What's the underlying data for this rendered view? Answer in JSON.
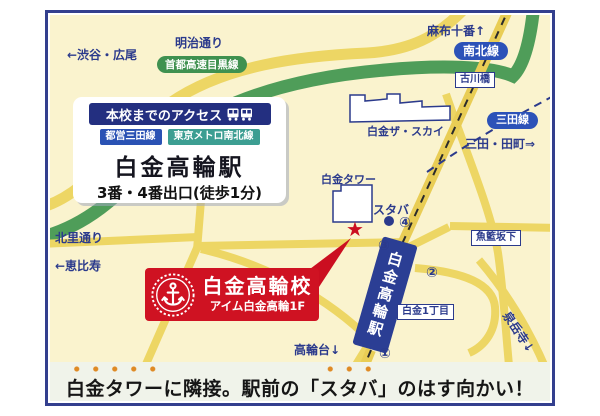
{
  "access_box": {
    "header": "本校までのアクセス",
    "line_badges": [
      {
        "label": "都営三田線",
        "color": "#2A52B4"
      },
      {
        "label": "東京メトロ南北線",
        "color": "#3C9E92"
      }
    ],
    "station": "白金高輪駅",
    "exit_info": "3番・4番出口(徒歩1分)"
  },
  "school_box": {
    "name": "白金高輪校",
    "address": "アイム白金高輪1F"
  },
  "map_labels": {
    "meiji_dori": "明治通り",
    "shibuya_hiroo": "←渋谷・広尾",
    "expressway": "首都高速目黒線",
    "azabu_juban": "麻布十番↑",
    "namboku_line": "南北線",
    "furukawabashi": "古川橋",
    "mita_line": "三田線",
    "mita_tamachi": "三田・田町⇒",
    "shirokane_the_sky": "白金ザ・スカイ",
    "shirokane_tower": "白金タワー",
    "starbucks": "スタバ",
    "gyoran_sakashita": "魚籃坂下",
    "shirokane_1chome": "白金1丁目",
    "kitasato_dori": "北里通り",
    "ebisu": "←恵比寿",
    "takanawadai": "高輪台↓",
    "sengakuji": "泉岳寺↓",
    "station_vertical": "白金高輪駅",
    "exits": [
      "①",
      "②",
      "③",
      "④"
    ]
  },
  "bottom_banner": {
    "parts": [
      {
        "text": "白金タワー",
        "emphasis": true
      },
      {
        "text": "に隣接。駅前の「",
        "emphasis": false
      },
      {
        "text": "スタバ",
        "emphasis": true
      },
      {
        "text": "」のはす向かい！",
        "emphasis": false
      }
    ]
  },
  "colors": {
    "map_background": "#FAF3CE",
    "frame_navy": "#333F8E",
    "road_yellow": "#EDD664",
    "expressway_green": "#4F9D59",
    "label_navy": "#2B3A8C",
    "line_badge_blue": "#2C52B8",
    "school_red": "#CF1222",
    "emphasis_orange": "#DF8A25",
    "banner_background": "#F0F3EA"
  }
}
